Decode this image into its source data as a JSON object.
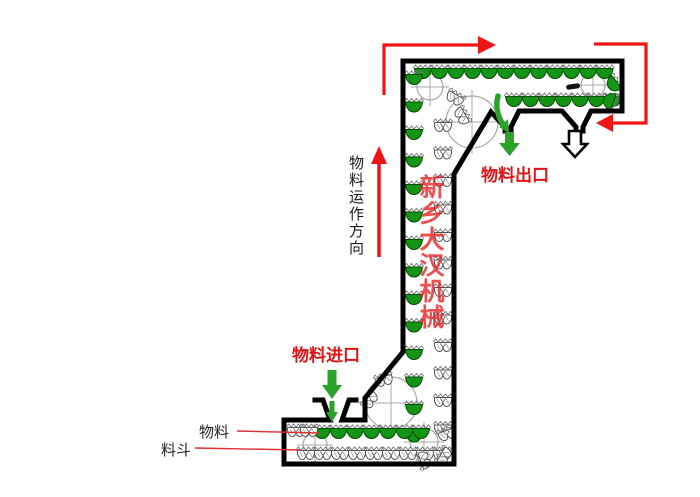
{
  "page": {
    "background": "#ffffff",
    "width": 700,
    "height": 497
  },
  "labels": {
    "flow_direction": "物料运作方向",
    "outlet": "物料出口",
    "inlet": "物料进口",
    "material": "物料",
    "bucket": "料斗",
    "watermark": "新乡大汉机械"
  },
  "colors": {
    "arrow_red": "#f11414",
    "label_red": "#e31212",
    "leader_red": "#e03030",
    "bucket_green": "#149414",
    "bucket_green_dark": "#044d04",
    "arrow_green": "#2ba32b",
    "outline_black": "#000000",
    "watermark_red": "rgba(231,28,28,0.78)",
    "pulley_gray": "#a8a8a8",
    "hatch_gray": "#777777"
  },
  "diagram": {
    "pulleys": [
      {
        "cx": 430,
        "cy": 87,
        "r": 13
      },
      {
        "cx": 593,
        "cy": 85,
        "r": 12
      },
      {
        "cx": 472,
        "cy": 122,
        "r": 26
      },
      {
        "cx": 391,
        "cy": 403,
        "r": 26
      },
      {
        "cx": 424,
        "cy": 442,
        "r": 14
      },
      {
        "cx": 315,
        "cy": 445,
        "r": 12
      }
    ],
    "bucket_rows": [
      {
        "type": "full",
        "x": 413,
        "y": 64,
        "dx": 16.5,
        "dy": 0,
        "count": 12
      },
      {
        "type": "full",
        "x": 504,
        "y": 92,
        "dx": 16.5,
        "dy": 0,
        "count": 7
      },
      {
        "type": "full",
        "x": 404,
        "y": 70,
        "dx": 0,
        "dy": 27.5,
        "count": 14
      },
      {
        "type": "empty",
        "x": 433,
        "y": 118,
        "dx": 0,
        "dy": 27.5,
        "count": 12
      },
      {
        "type": "full",
        "x": 312,
        "y": 424,
        "dx": 16.5,
        "dy": 0,
        "count": 7
      },
      {
        "type": "empty",
        "x": 296,
        "y": 446,
        "dx": 17,
        "dy": 0,
        "count": 9
      },
      {
        "type": "empty",
        "x": 286,
        "y": 423,
        "dx": 13,
        "dy": 0,
        "count": 2
      }
    ],
    "bucket_singles": [
      {
        "type": "full",
        "x": 604,
        "y": 76,
        "rot": 50
      },
      {
        "type": "full",
        "x": 600,
        "y": 93,
        "rot": 110
      },
      {
        "type": "empty",
        "x": 445,
        "y": 90,
        "rot": 30
      },
      {
        "type": "empty",
        "x": 452,
        "y": 108,
        "rot": 60
      },
      {
        "type": "empty",
        "x": 374,
        "y": 372,
        "rot": -15
      },
      {
        "type": "empty",
        "x": 360,
        "y": 392,
        "rot": -55
      },
      {
        "type": "empty",
        "x": 437,
        "y": 426,
        "rot": -20
      },
      {
        "type": "empty",
        "x": 434,
        "y": 448,
        "rot": -60
      },
      {
        "type": "empty",
        "x": 414,
        "y": 452,
        "rot": -110
      }
    ]
  }
}
